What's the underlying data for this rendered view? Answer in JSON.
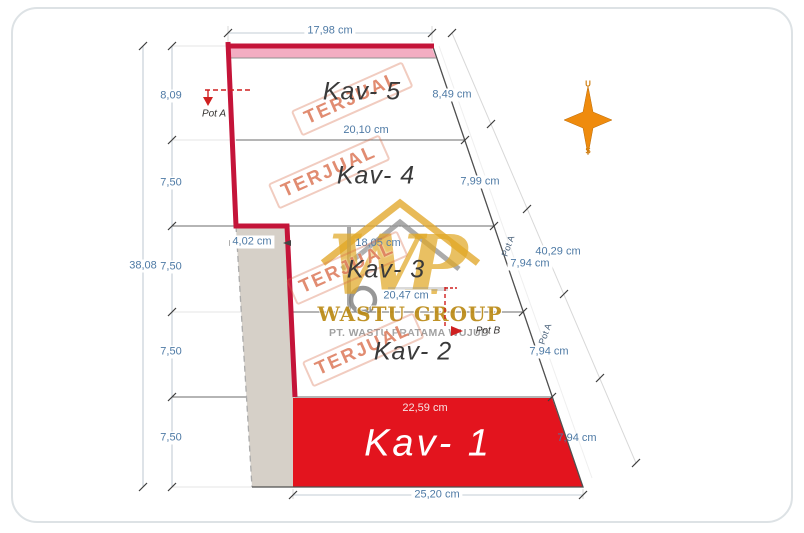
{
  "drawing": {
    "type": "site-plan",
    "dimensions": {
      "top_width": "17,98 cm",
      "left_total": "38,08",
      "left_segments": [
        "8,09",
        "7,50",
        "7,50",
        "7,50",
        "7,50"
      ],
      "inner_widths": [
        "20,10 cm",
        "18,05 cm",
        "20,47 cm"
      ],
      "kav1_top_width": "22,59 cm",
      "bottom_width": "25,20 cm",
      "cut_strip_width": "4,02 cm",
      "right_segments": [
        "8,49 cm",
        "7,99 cm",
        "7,94 cm",
        "7,94 cm",
        "7,94 cm"
      ],
      "right_total": "40,29 cm"
    },
    "plots": [
      {
        "label": "Kav- 5",
        "status": "TERJUAL"
      },
      {
        "label": "Kav- 4",
        "status": "TERJUAL"
      },
      {
        "label": "Kav- 3",
        "status": "TERJUAL"
      },
      {
        "label": "Kav- 2",
        "status": "TERJUAL"
      },
      {
        "label": "Kav- 1",
        "status": ""
      }
    ],
    "section_markers": {
      "pot_a": "Pot A",
      "pot_b": "Pot B",
      "edge_a1": "Pot A",
      "edge_a2": "Pot A"
    },
    "compass": {
      "north_label": "U",
      "south_label": "S"
    },
    "watermark": {
      "monogram": "WP",
      "company": "WASTU GROUP",
      "company_subtitle": "PT. WASTU PRATAMA WUJUD"
    },
    "colors": {
      "boundary_red": "#c41439",
      "sold_fill_red": "#e3141e",
      "frontage_pink": "#f3adc2",
      "cut_strip_gray": "#d6d0c8",
      "dimension_blue": "#4e7aa5",
      "stamp_orange": "#d55f3a",
      "watermark_gold": "#e0a826",
      "compass_orange": "#ef8b0d"
    }
  }
}
